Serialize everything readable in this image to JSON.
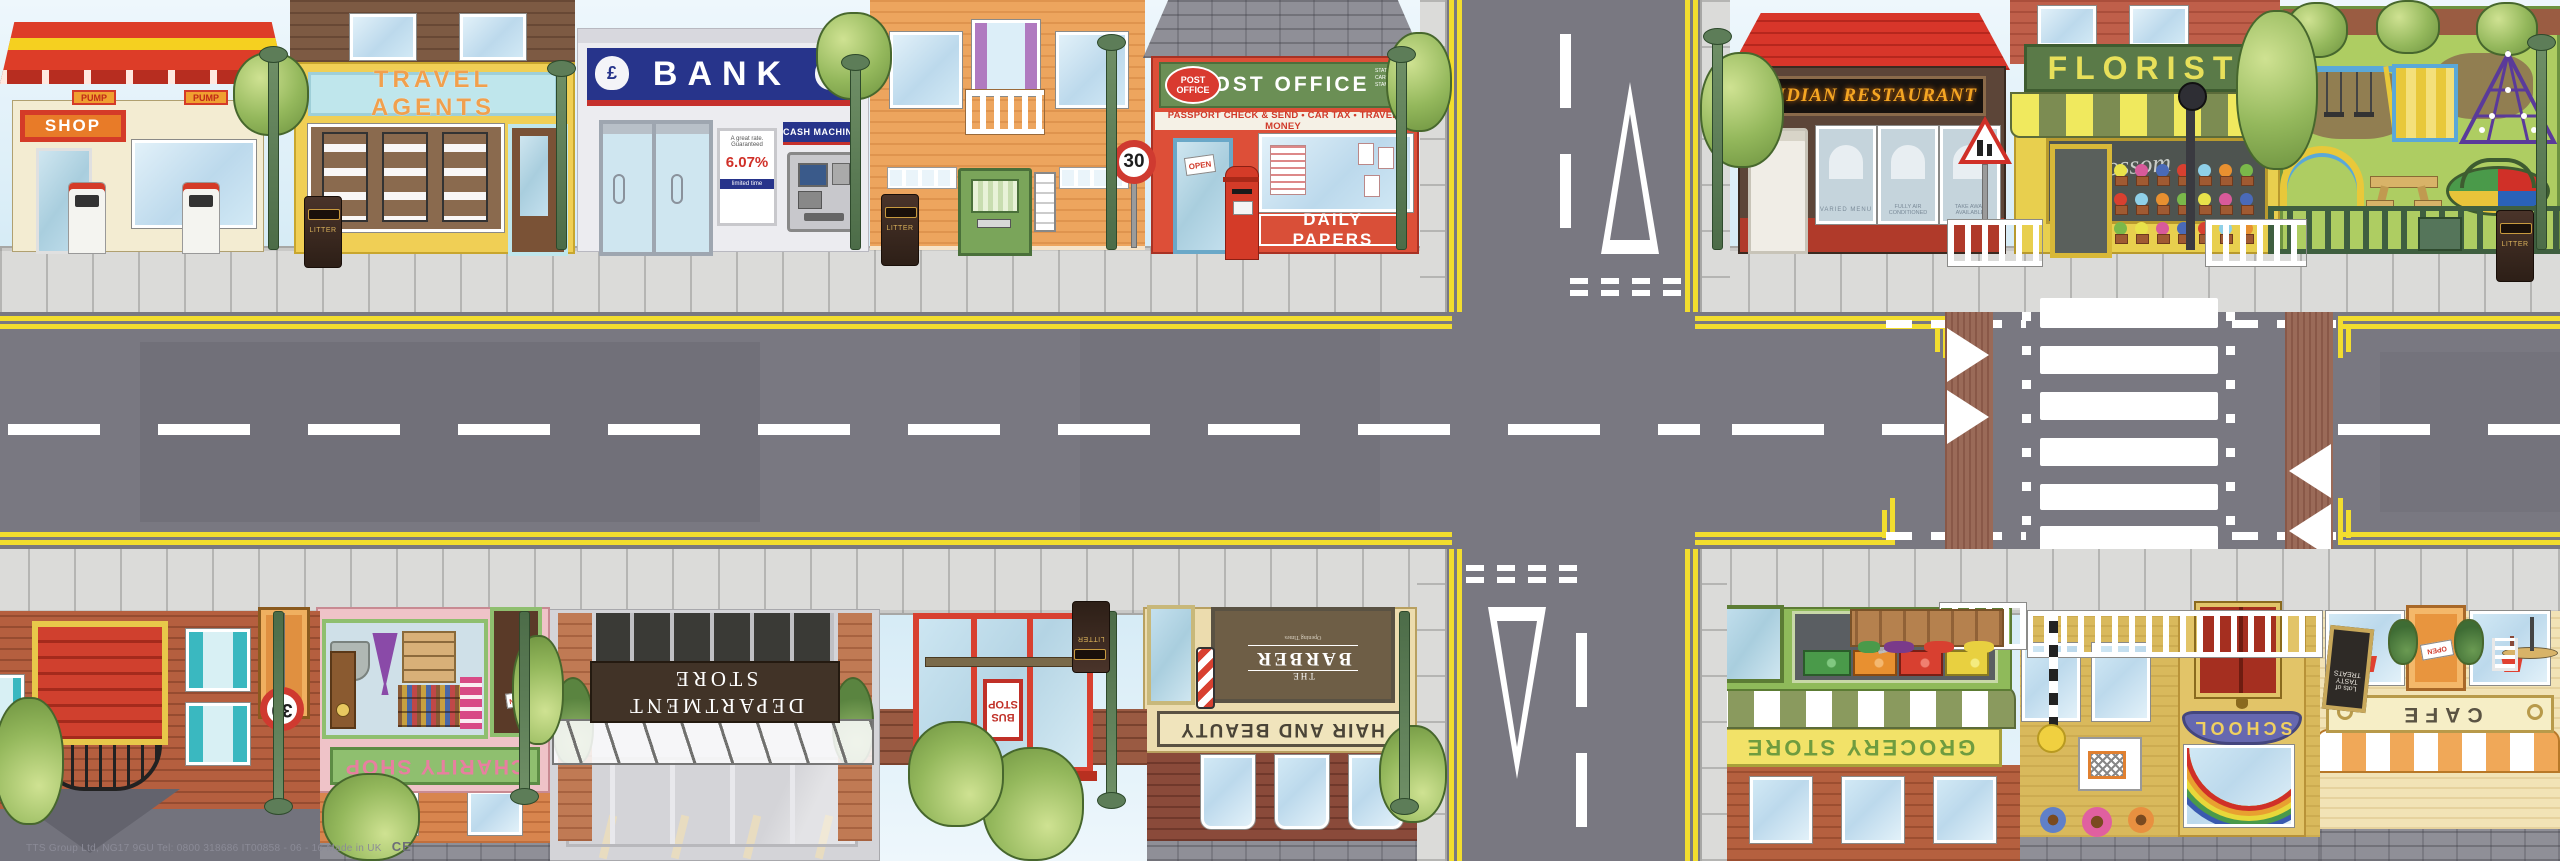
{
  "footer": {
    "brand": "TTS Group Ltd, NG17 9GU Tel: 0800 318686 IT00858 - 06 - 16 Made in UK",
    "ce": "CE"
  },
  "street": {
    "litter": "LITTER",
    "speed": "30",
    "open": "OPEN"
  },
  "road": {
    "accent_yellow": "#f2dd2e",
    "tarmac": "#797881"
  },
  "top": {
    "petrol": {
      "shop": "SHOP",
      "pump": "PUMP"
    },
    "travel": {
      "sign": "TRAVEL AGENTS"
    },
    "bank": {
      "sign": "BANK",
      "currency": "£",
      "cash": "CASH MACHINE",
      "p1": "A great rate.",
      "p2": "Guaranteed",
      "rate": "6.07%",
      "p3": "limited time"
    },
    "post": {
      "logo1": "POST",
      "logo2": "OFFICE",
      "sign": "POST OFFICE",
      "side": "STATIONERY\nCARDS\nSTAMPS",
      "banner": "PASSPORT CHECK & SEND • CAR TAX • TRAVEL MONEY",
      "papers": "DAILY PAPERS"
    },
    "indian": {
      "sign": "INDIAN RESTAURANT",
      "w1": "VARIED MENU",
      "w2": "FULLY AIR CONDITIONED",
      "w3": "TAKE AWAY AVAILABLE"
    },
    "florist": {
      "sign": "FLORIST",
      "script": "Blossom"
    }
  },
  "bot": {
    "cafe": {
      "sign": "CAFE",
      "board": "Lots of TASTY TREATS"
    },
    "school": {
      "sign": "SCHOOL"
    },
    "grocery": {
      "sign": "GROCERY STORE"
    },
    "bus": {
      "l1": "BUS",
      "l2": "STOP"
    },
    "hair": {
      "sign": "HAIR AND BEAUTY",
      "w1": "THE",
      "w2": "BARBER",
      "small": "Opening Times"
    },
    "dept": {
      "l1": "DEPARTMENT",
      "l2": "STORE"
    },
    "charity": {
      "sign": "CHARITY SHOP"
    }
  }
}
